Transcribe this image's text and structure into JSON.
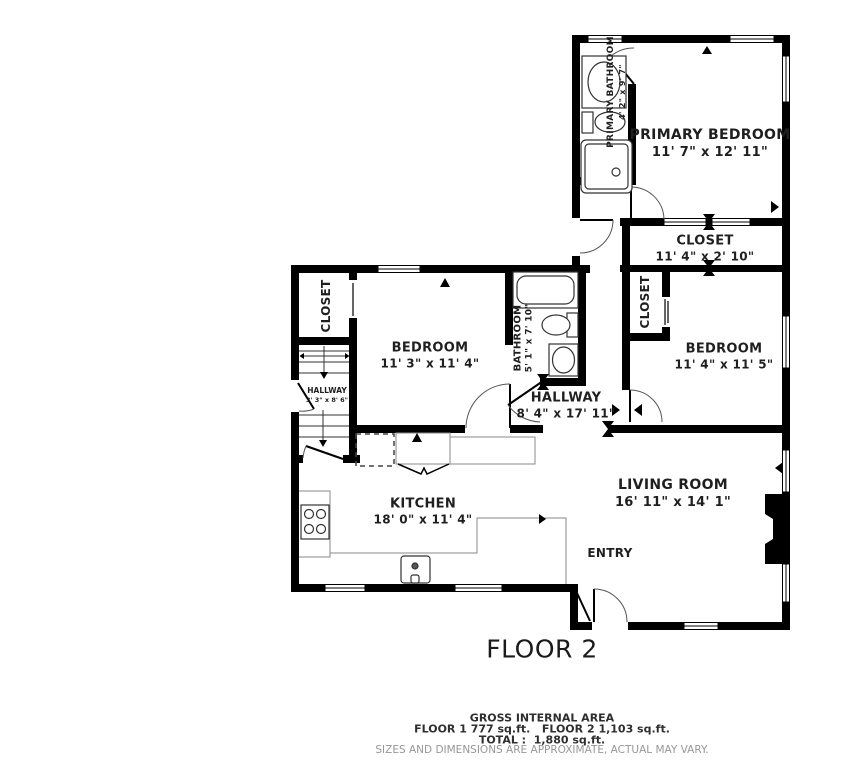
{
  "floor_label": "FLOOR 2",
  "rooms": {
    "primary_bathroom": {
      "name": "PRIMARY BATHROOM",
      "dims": "4' 2\" x 9' 7\""
    },
    "primary_bedroom": {
      "name": "PRIMARY BEDROOM",
      "dims": "11' 7\" x 12' 11\""
    },
    "closet_top": {
      "name": "CLOSET",
      "dims": "11' 4\" x 2' 10\""
    },
    "closet_right": {
      "name": "CLOSET"
    },
    "bedroom_right": {
      "name": "BEDROOM",
      "dims": "11' 4\" x 11' 5\""
    },
    "closet_left": {
      "name": "CLOSET"
    },
    "bedroom_left": {
      "name": "BEDROOM",
      "dims": "11' 3\" x 11' 4\""
    },
    "bathroom": {
      "name": "BATHROOM",
      "dims": "5' 1\" x 7' 10\""
    },
    "hallway_small": {
      "name": "HALLWAY",
      "dims": "3' 3\" x 8' 6\""
    },
    "hallway": {
      "name": "HALLWAY",
      "dims": "8' 4\" x 17' 11\""
    },
    "kitchen": {
      "name": "KITCHEN",
      "dims": "18' 0\" x 11' 4\""
    },
    "living_room": {
      "name": "LIVING ROOM",
      "dims": "16' 11\" x 14' 1\""
    },
    "entry": {
      "name": "ENTRY"
    }
  },
  "footer": {
    "area_title": "GROSS INTERNAL AREA",
    "floors_line": "FLOOR 1 777 sq.ft.   FLOOR 2 1,103 sq.ft.",
    "total_line": "TOTAL :  1,880 sq.ft.",
    "disclaimer": "SIZES AND DIMENSIONS ARE APPROXIMATE, ACTUAL MAY VARY."
  },
  "colors": {
    "wall": "#000000",
    "label": "#1f1f1f",
    "disclaimer": "#979797"
  }
}
